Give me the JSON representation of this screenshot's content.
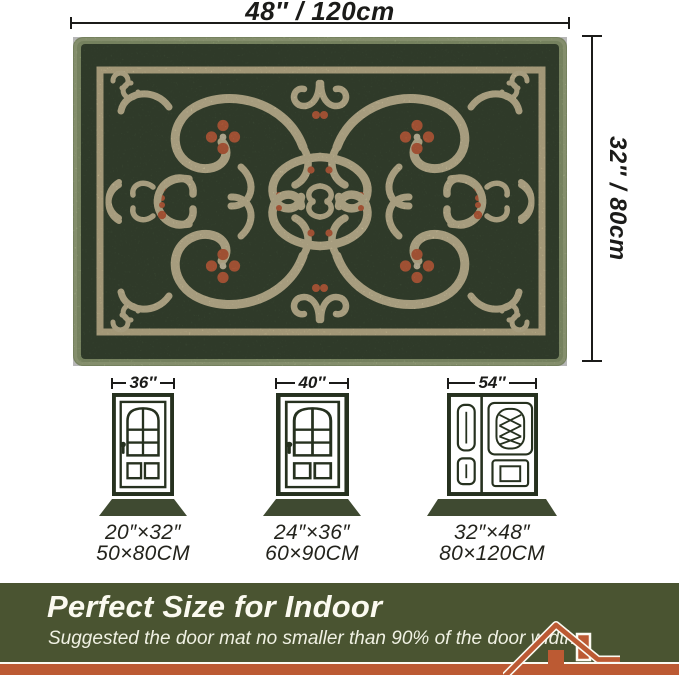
{
  "rug": {
    "description": "green ornate scrollwork door mat",
    "width_label": "48″ / 120cm",
    "height_label": "32″ / 80cm",
    "colors": {
      "binding": "#a3b484",
      "field": "#42523a",
      "pattern": "#e8dab0",
      "accent": "#dd7048"
    }
  },
  "doors": [
    {
      "width_label": "36″",
      "mat_inches": "20″×32″",
      "mat_cm": "50×80CM",
      "type": "single"
    },
    {
      "width_label": "40″",
      "mat_inches": "24″×36″",
      "mat_cm": "60×90CM",
      "type": "single"
    },
    {
      "width_label": "54″",
      "mat_inches": "32″×48″",
      "mat_cm": "80×120CM",
      "type": "double"
    }
  ],
  "banner": {
    "title": "Perfect Size for Indoor",
    "subtitle": "Suggested the door mat no smaller than 90% of the door width.",
    "colors": {
      "background": "#4a5431",
      "stripe": "#bc5a33",
      "text": "#fbfaf0"
    }
  },
  "icons": {
    "house": "house-roof",
    "dimension": "double-ended-measure-line"
  }
}
